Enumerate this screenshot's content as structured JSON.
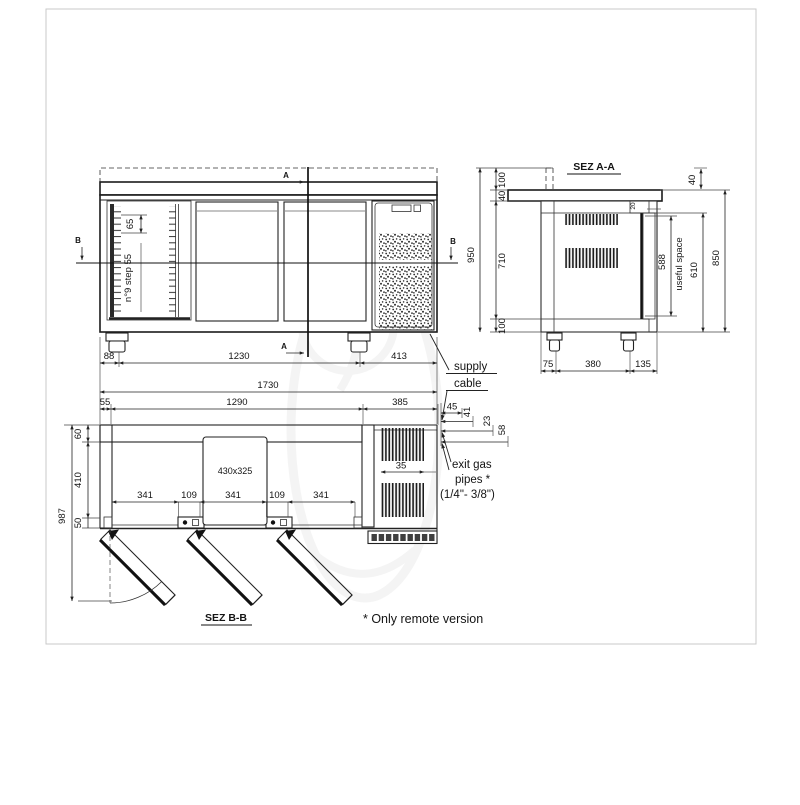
{
  "colors": {
    "line": "#1a1a1a",
    "background": "#ffffff",
    "watermark": "#ececec"
  },
  "front_view": {
    "section_a": "A",
    "section_b": "B",
    "shelf_pitch": "65",
    "shelf_note": "n°9 step 55",
    "bottom_dims": [
      "88",
      "1230",
      "413"
    ]
  },
  "overall_dims": {
    "total_width": "1730",
    "plan_top": [
      "55",
      "1290",
      "385"
    ]
  },
  "sez_aa": {
    "title": "SEZ A-A",
    "left_chain": [
      "100",
      "40",
      "710",
      "100"
    ],
    "left_total": "950",
    "worktop_thickness": "40",
    "door_top_gap": "20",
    "useful_height": "588",
    "useful_label": "useful space",
    "door_height": "610",
    "body_height": "850",
    "bottom_dims": [
      "75",
      "380",
      "135"
    ]
  },
  "sez_bb": {
    "title": "SEZ B-B",
    "left_chain": [
      "60",
      "410",
      "50"
    ],
    "left_total": "987",
    "interior_dims": [
      "341",
      "109",
      "341",
      "109",
      "341"
    ],
    "evaporator_label": "430x325",
    "grille_width": "35",
    "pipe_dims": [
      "45",
      "41",
      "23",
      "58"
    ]
  },
  "annotations": {
    "supply_cable": [
      "supply",
      "cable"
    ],
    "exit_gas": [
      "exit gas",
      "pipes *",
      "(1/4\"- 3/8\")"
    ],
    "footnote": "* Only remote version"
  }
}
